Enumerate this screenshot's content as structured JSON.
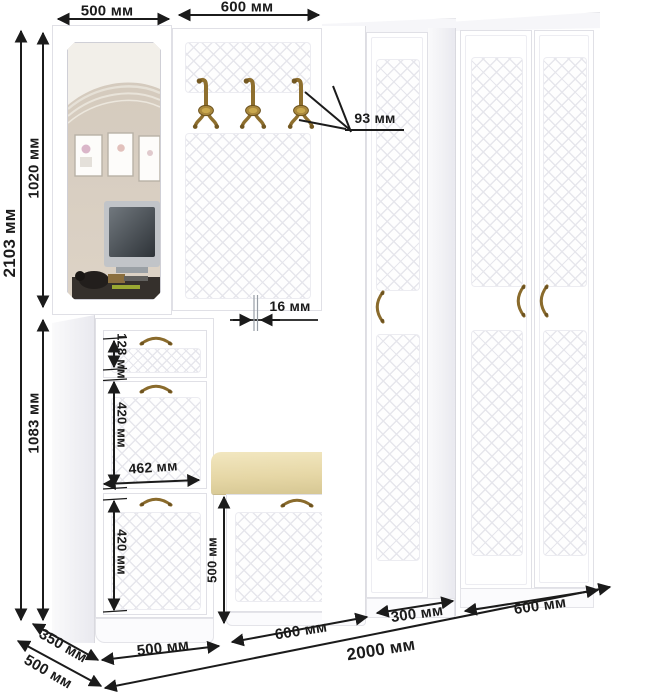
{
  "page": {
    "background": "#ffffff"
  },
  "colors": {
    "dimension_ink": "#1b1b1b",
    "bronze_hardware": "#8e6f2e",
    "cushion_beige": "#e9daa9",
    "furniture_edge": "#e0e0e6"
  },
  "dimensions": {
    "top": {
      "mirror_section_width": "500 мм",
      "hook_panel_width": "600 мм"
    },
    "left": {
      "total_height": "2103 мм",
      "upper_section_height": "1020 мм",
      "lower_section_height": "1083 мм"
    },
    "details": {
      "hook_depth": "93 мм",
      "panel_thickness": "16 мм",
      "drawer_height": "128 мм",
      "upper_flap_height": "420 мм",
      "inner_width": "462 мм",
      "lower_flap_height": "420 мм",
      "bench_height": "500 мм"
    },
    "bottom": {
      "cabinet_width": "500 мм",
      "bench_width": "600 мм",
      "narrow_wardrobe_width": "300 мм",
      "wide_wardrobe_width": "600 мм",
      "total_width": "2000 мм"
    },
    "depth": {
      "cabinet_depth": "350 мм",
      "wardrobe_depth": "500 мм"
    }
  }
}
